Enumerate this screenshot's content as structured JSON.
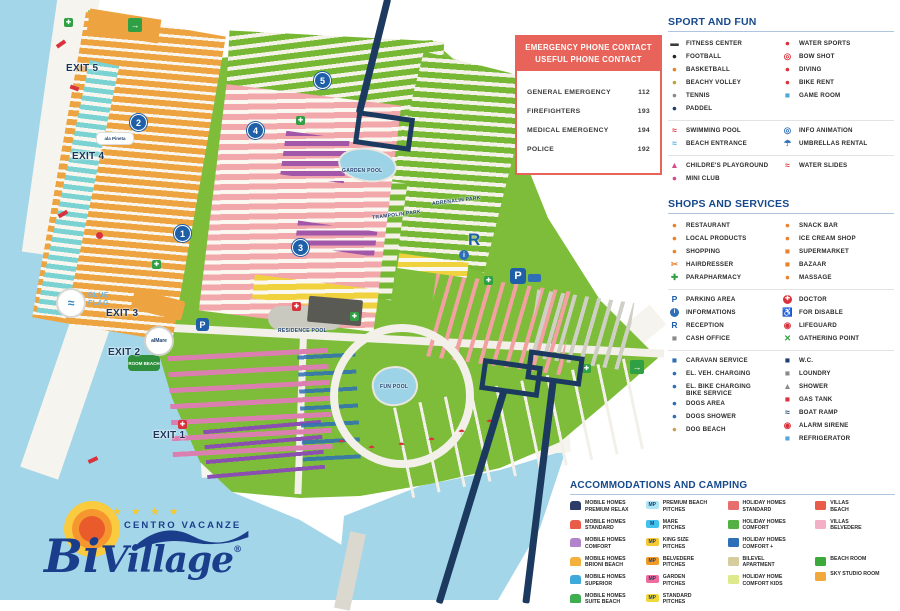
{
  "emergency": {
    "title1": "EMERGENCY PHONE CONTACT",
    "title2": "USEFUL PHONE CONTACT",
    "rows": [
      {
        "label": "GENERAL EMERGENCY",
        "number": "112"
      },
      {
        "label": "FIREFIGHTERS",
        "number": "193"
      },
      {
        "label": "MEDICAL EMERGENCY",
        "number": "194"
      },
      {
        "label": "POLICE",
        "number": "192"
      }
    ]
  },
  "legend": {
    "sport_title": "SPORT AND FUN",
    "shops_title": "SHOPS AND SERVICES",
    "accom_title": "ACCOMMODATIONS AND CAMPING",
    "sport_groups": [
      {
        "left": [
          {
            "label": "FITNESS CENTER",
            "icon": "dumbbell-icon",
            "color": "#3A3A3A",
            "char": "▬"
          },
          {
            "label": "FOOTBALL",
            "icon": "football-icon",
            "color": "#2A2A2A",
            "char": "●"
          },
          {
            "label": "BASKETBALL",
            "icon": "basketball-icon",
            "color": "#E8832C",
            "char": "●"
          },
          {
            "label": "BEACHY VOLLEY",
            "icon": "volleyball-icon",
            "color": "#C0A53C",
            "char": "●"
          },
          {
            "label": "TENNIS",
            "icon": "tennis-racket-icon",
            "color": "#8A8A8A",
            "char": "●"
          },
          {
            "label": "PADDEL",
            "icon": "paddle-icon",
            "color": "#1C3F6E",
            "char": "●"
          }
        ],
        "right": [
          {
            "label": "WATER SPORTS",
            "icon": "water-ski-icon",
            "color": "#D8333C",
            "char": "●"
          },
          {
            "label": "BOW SHOT",
            "icon": "target-icon",
            "color": "#D8333C",
            "char": "◎"
          },
          {
            "label": "DIVING",
            "icon": "diver-icon",
            "color": "#D8333C",
            "char": "●"
          },
          {
            "label": "BIKE RENT",
            "icon": "bicycle-icon",
            "color": "#D8333C",
            "char": "●"
          },
          {
            "label": "GAME ROOM",
            "icon": "gamepad-icon",
            "color": "#4FA8D8",
            "char": "■"
          }
        ]
      },
      {
        "left": [
          {
            "label": "SWIMMING POOL",
            "icon": "swimmer-icon",
            "color": "#D8333C",
            "char": "≈"
          },
          {
            "label": "BEACH ENTRANCE",
            "icon": "beach-chair-icon",
            "color": "#4FA8D8",
            "char": "≈"
          }
        ],
        "right": [
          {
            "label": "INFO ANIMATION",
            "icon": "info-animation-icon",
            "color": "#2E6FB7",
            "char": "◎"
          },
          {
            "label": "UMBRELLAS RENTAL",
            "icon": "umbrella-icon",
            "color": "#2E6FB7",
            "char": "☂"
          }
        ]
      },
      {
        "left": [
          {
            "label": "CHILDRE'S PLAYGROUND",
            "icon": "slide-icon",
            "color": "#D8488C",
            "char": "▲"
          },
          {
            "label": "MINI CLUB",
            "icon": "map-pin-icon",
            "color": "#D8488C",
            "char": "●"
          }
        ],
        "right": [
          {
            "label": "WATER SLIDES",
            "icon": "water-slide-icon",
            "color": "#D8333C",
            "char": "≈"
          }
        ]
      }
    ],
    "shops_groups": [
      {
        "left": [
          {
            "label": "RESTAURANT",
            "icon": "cutlery-icon",
            "color": "#E8832C",
            "char": "●"
          },
          {
            "label": "LOCAL PRODUCTS",
            "icon": "local-products-icon",
            "color": "#E8832C",
            "char": "●"
          },
          {
            "label": "SHOPPING",
            "icon": "shirt-icon",
            "color": "#E8832C",
            "char": "●"
          },
          {
            "label": "HAIRDRESSER",
            "icon": "scissors-icon",
            "color": "#E8832C",
            "char": "✂"
          },
          {
            "label": "PARAPHARMACY",
            "icon": "green-cross-icon",
            "color": "#2FA043",
            "char": "✚"
          }
        ],
        "right": [
          {
            "label": "SNACK BAR",
            "icon": "snack-bar-icon",
            "color": "#E8832C",
            "char": "●"
          },
          {
            "label": "ICE CREAM SHOP",
            "icon": "ice-cream-icon",
            "color": "#E8832C",
            "char": "●"
          },
          {
            "label": "SUPERMARKET",
            "icon": "cart-icon",
            "color": "#E8832C",
            "char": "■"
          },
          {
            "label": "BAZAAR",
            "icon": "bazaar-icon",
            "color": "#E8832C",
            "char": "■"
          },
          {
            "label": "MASSAGE",
            "icon": "massage-icon",
            "color": "#E8832C",
            "char": "●"
          }
        ]
      },
      {
        "left": [
          {
            "label": "PARKING AREA",
            "icon": "parking-icon",
            "color": "#1F5FA8",
            "char": "P"
          },
          {
            "label": "INFORMATIONS",
            "icon": "info-icon",
            "color": "#fff",
            "bg": "#2E6FB7",
            "char": "i"
          },
          {
            "label": "RECEPTION",
            "icon": "reception-icon",
            "color": "#1F5FA8",
            "char": "R"
          },
          {
            "label": "CASH OFFICE",
            "icon": "cash-office-icon",
            "color": "#8A8A8A",
            "char": "■"
          }
        ],
        "right": [
          {
            "label": "DOCTOR",
            "icon": "doctor-cross-icon",
            "color": "#fff",
            "bg": "#D8333C",
            "char": "✚"
          },
          {
            "label": "FOR DISABLE",
            "icon": "wheelchair-icon",
            "color": "#2E6FB7",
            "char": "♿"
          },
          {
            "label": "LIFEGUARD",
            "icon": "lifebuoy-icon",
            "color": "#D8333C",
            "char": "◉"
          },
          {
            "label": "GATHERING POINT",
            "icon": "gathering-point-icon",
            "color": "#2FA043",
            "char": "✕"
          }
        ]
      },
      {
        "left": [
          {
            "label": "CARAVAN SERVICE",
            "icon": "caravan-icon",
            "color": "#2E6FB7",
            "char": "■"
          },
          {
            "label": "EL. VEH. CHARGING",
            "icon": "ev-charging-icon",
            "color": "#2E6FB7",
            "char": "●"
          },
          {
            "label": "EL. BIKE CHARGING\nBIKE SERVICE",
            "icon": "ebike-charging-icon",
            "color": "#2E6FB7",
            "char": "●"
          },
          {
            "label": "DOGS AREA",
            "icon": "dog-icon",
            "color": "#2E6FB7",
            "char": "●"
          },
          {
            "label": "DOGS SHOWER",
            "icon": "dog-shower-icon",
            "color": "#2E6FB7",
            "char": "●"
          },
          {
            "label": "DOG BEACH",
            "icon": "dog-beach-icon",
            "color": "#C8A05C",
            "char": "●"
          }
        ],
        "right": [
          {
            "label": "W.C.",
            "icon": "wc-icon",
            "color": "#1C3F6E",
            "char": "■"
          },
          {
            "label": "LOUNDRY",
            "icon": "laundry-icon",
            "color": "#8A8A8A",
            "char": "■"
          },
          {
            "label": "SHOWER",
            "icon": "shower-icon",
            "color": "#8A8A8A",
            "char": "▲"
          },
          {
            "label": "GAS TANK",
            "icon": "gas-tank-icon",
            "color": "#D8333C",
            "char": "■"
          },
          {
            "label": "BOAT RAMP",
            "icon": "boat-ramp-icon",
            "color": "#1C3F6E",
            "char": "≈"
          },
          {
            "label": "ALARM SIRENE",
            "icon": "alarm-icon",
            "color": "#D8333C",
            "char": "◉"
          },
          {
            "label": "REFRIGERATOR",
            "icon": "refrigerator-icon",
            "color": "#4FA8D8",
            "char": "■"
          }
        ]
      }
    ],
    "accom_columns": [
      [
        {
          "label": "MOBILE HOMES\nPREMIUM RELAX",
          "icon": "mobile-home-premium-relax-icon",
          "type": "home",
          "color": "#2E3B68"
        },
        {
          "label": "MOBILE HOMES\nSTANDARD",
          "icon": "mobile-home-standard-icon",
          "type": "home",
          "color": "#E85C49"
        },
        {
          "label": "MOBILE HOMES\nCOMFORT",
          "icon": "mobile-home-comfort-icon",
          "type": "home",
          "color": "#B184C9"
        },
        {
          "label": "MOBILE HOMES\nBRIONI BEACH",
          "icon": "mobile-home-brioni-beach-icon",
          "type": "home",
          "color": "#F2B03C"
        },
        {
          "label": "MOBILE HOMES\nSUPERIOR",
          "icon": "mobile-home-superior-icon",
          "type": "home",
          "color": "#3FA9DB"
        },
        {
          "label": "MOBILE HOMES\nSUITE BEACH",
          "icon": "mobile-home-suite-beach-icon",
          "type": "home",
          "color": "#3FAE52"
        }
      ],
      [
        {
          "label": "PREMIUM BEACH\nPITCHES",
          "icon": "premium-beach-pitch-icon",
          "type": "badge",
          "color": "#AEE6F6",
          "char": "MP"
        },
        {
          "label": "MARE\nPITCHES",
          "icon": "mare-pitch-icon",
          "type": "badge",
          "color": "#41C1EE",
          "char": "M"
        },
        {
          "label": "KING SIZE\nPITCHES",
          "icon": "king-size-pitch-icon",
          "type": "badge",
          "color": "#F6C832",
          "char": "MP"
        },
        {
          "label": "BELVEDERE\nPITCHES",
          "icon": "belvedere-pitch-icon",
          "type": "badge",
          "color": "#F09A28",
          "char": "MP"
        },
        {
          "label": "GARDEN\nPITCHES",
          "icon": "garden-pitch-icon",
          "type": "badge",
          "color": "#F06C9C",
          "char": "MP"
        },
        {
          "label": "STANDARD\nPITCHES",
          "icon": "standard-pitch-icon",
          "type": "badge",
          "color": "#F0D838",
          "char": "MP"
        }
      ],
      [
        {
          "label": "HOLIDAY HOMES\nSTANDARD",
          "icon": "holiday-home-standard-icon",
          "type": "block",
          "color": "#E86E6E"
        },
        {
          "label": "HOLIDAY HOMES\nCOMFORT",
          "icon": "holiday-home-comfort-icon",
          "type": "block",
          "color": "#53B043"
        },
        {
          "label": "HOLIDAY HOMES\nCOMFORT +",
          "icon": "holiday-home-comfort-plus-icon",
          "type": "block",
          "color": "#2E6FB7"
        },
        {
          "label": "BILEVEL\nAPARTMENT",
          "icon": "bilevel-apartment-icon",
          "type": "block",
          "color": "#D6CC9E"
        },
        {
          "label": "HOLIDAY HOME\nCOMFORT KIDS",
          "icon": "holiday-home-comfort-kids-icon",
          "type": "block",
          "color": "#DDE98A"
        }
      ],
      [
        {
          "label": "VILLAS\nBEACH",
          "icon": "villas-beach-icon",
          "type": "block",
          "color": "#E85C49"
        },
        {
          "label": "VILLAS\nBELVEDERE",
          "icon": "villas-belvedere-icon",
          "type": "block",
          "color": "#F4AEC6"
        },
        {
          "label": "",
          "icon": "spacer",
          "type": "spacer",
          "color": ""
        },
        {
          "label": "BEACH ROOM",
          "icon": "beach-room-icon",
          "type": "block",
          "color": "#3BAA3B"
        },
        {
          "label": "SKY STUDIO ROOM",
          "icon": "sky-studio-room-icon",
          "type": "block",
          "color": "#F2A93C"
        }
      ]
    ]
  },
  "map": {
    "exits": [
      "EXIT 5",
      "EXIT 4",
      "EXIT 3",
      "EXIT 2",
      "EXIT 1"
    ],
    "markers": [
      "1",
      "2",
      "3",
      "4",
      "5"
    ],
    "blue_flag_line1": "BLUE",
    "blue_flag_line2": "FLAG",
    "garden_pool": "GARDEN POOL",
    "trampolin_park": "TRAMPOLIN PARK",
    "adrenalin_park": "ADRENALIN PARK",
    "residence_pool": "RESIDENCE POOL",
    "fun_pool": "FUN POOL",
    "room_beach": "ROOM BEACH",
    "almare": "alMare",
    "ala_pineta": "ala Pineta",
    "parking_letter": "P",
    "reception_letter": "R",
    "info_letter": "i",
    "arrow": "→",
    "plus": "✚",
    "umbrella": "☂",
    "wave": "≈"
  },
  "logo": {
    "stars": "★ ★ ★ ★",
    "tagline": "CENTRO VACANZE",
    "name_bi": "Bi",
    "name_village": "Village",
    "reg": "®"
  }
}
